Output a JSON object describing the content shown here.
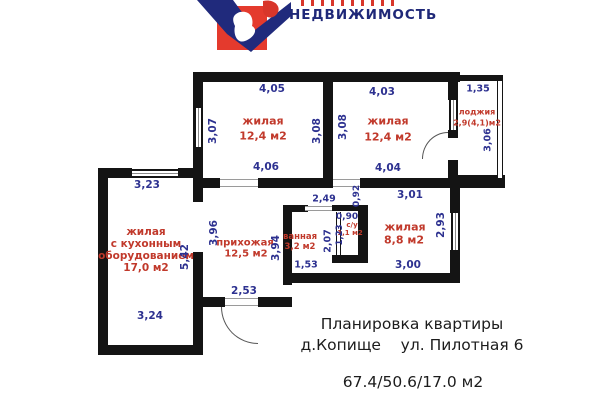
{
  "brand": {
    "wordmark": "НЕДВИЖИМОСТЬ"
  },
  "plan": {
    "rooms": {
      "room1": {
        "name": "жилая",
        "area": "12,4 м2"
      },
      "room2": {
        "name": "жилая",
        "area": "12,4 м2"
      },
      "loggia": {
        "name": "лоджия",
        "area": "2,9(4,1)м2"
      },
      "kitchen_living": {
        "name_line1": "жилая",
        "name_line2": "с кухонным",
        "name_line3": "оборудованием",
        "area": "17,0 м2"
      },
      "hall": {
        "name": "прихожая",
        "area": "12,5 м2"
      },
      "bathroom": {
        "name": "ванная",
        "area": "3,2 м2"
      },
      "wc": {
        "name": "с/у",
        "area": "1,1 м2"
      },
      "room3": {
        "name": "жилая",
        "area": "8,8 м2"
      }
    },
    "dims": {
      "room1_top": "4,05",
      "room1_left": "3,07",
      "room1_right": "3,08",
      "room1_bottom": "4,06",
      "room2_top": "4,03",
      "room2_left": "3,08",
      "room2_bottom": "4,04",
      "loggia_top": "1,35",
      "loggia_right": "3,06",
      "kitchen_top": "3,23",
      "kitchen_right": "5,42",
      "kitchen_bottom": "3,24",
      "hall_left": "3,96",
      "hall_right": "3,94",
      "hall_entry": "2,53",
      "bath_top": "2,49",
      "bath_right": "2,07",
      "bath_bottom": "1,53",
      "wc_top": "0,90",
      "wc_left": "1,23",
      "vestibule": "0,92",
      "room3_top": "3,01",
      "room3_right": "2,93",
      "room3_bottom": "3,00"
    }
  },
  "footer": {
    "title": "Планировка квартиры",
    "address": "д.Копище    ул. Пилотная 6",
    "areas": "67.4/50.6/17.0 м2"
  },
  "colors": {
    "wall": "#141414",
    "dimension_text": "#2d3190",
    "room_text": "#c1392b",
    "logo_red": "#e43a2d",
    "logo_navy": "#202a7c"
  }
}
